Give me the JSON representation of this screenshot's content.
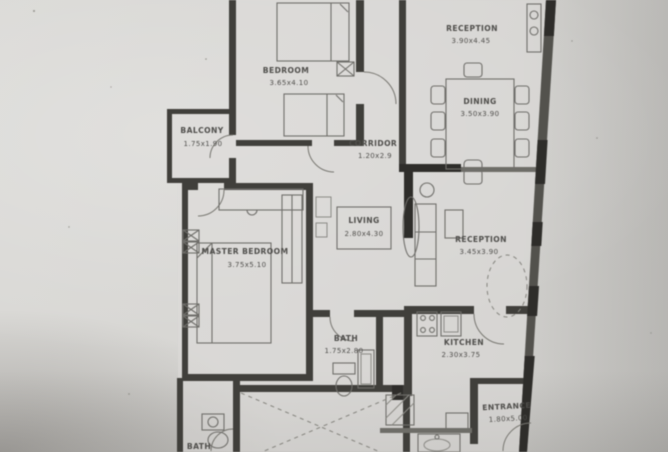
{
  "document": {
    "kind": "apartment floor plan photo",
    "orientation": "portrait plan, cropped at top and bottom edges"
  },
  "rooms": {
    "reception_top": {
      "name": "RECEPTION",
      "dims": "3.90x4.45"
    },
    "bedroom": {
      "name": "BEDROOM",
      "dims": "3.65x4.10"
    },
    "balcony": {
      "name": "BALCONY",
      "dims": "1.75x1.90"
    },
    "corridor": {
      "name": "CORRIDOR",
      "dims": "1.20x2.9"
    },
    "dining": {
      "name": "DINING",
      "dims": "3.50x3.90"
    },
    "living": {
      "name": "LIVING",
      "dims": "2.80x4.30"
    },
    "reception_mid": {
      "name": "RECEPTION",
      "dims": "3.45x3.90"
    },
    "master_bedroom": {
      "name": "MASTER BEDROOM",
      "dims": "3.75x5.10"
    },
    "bath": {
      "name": "BATH",
      "dims": "1.75x2.80"
    },
    "kitchen": {
      "name": "KITCHEN",
      "dims": "2.30x3.75"
    },
    "entrance": {
      "name": "ENTRANCE",
      "dims": "1.80x5.00"
    },
    "bath_2": {
      "name": "BATH",
      "dims": ""
    }
  },
  "colors": {
    "paper": "#d6d5d2",
    "wall": "#403f3b",
    "wall_dark": "#2e2d2a",
    "furniture_line": "#6f6e6a",
    "text": "#4f4e4b"
  }
}
